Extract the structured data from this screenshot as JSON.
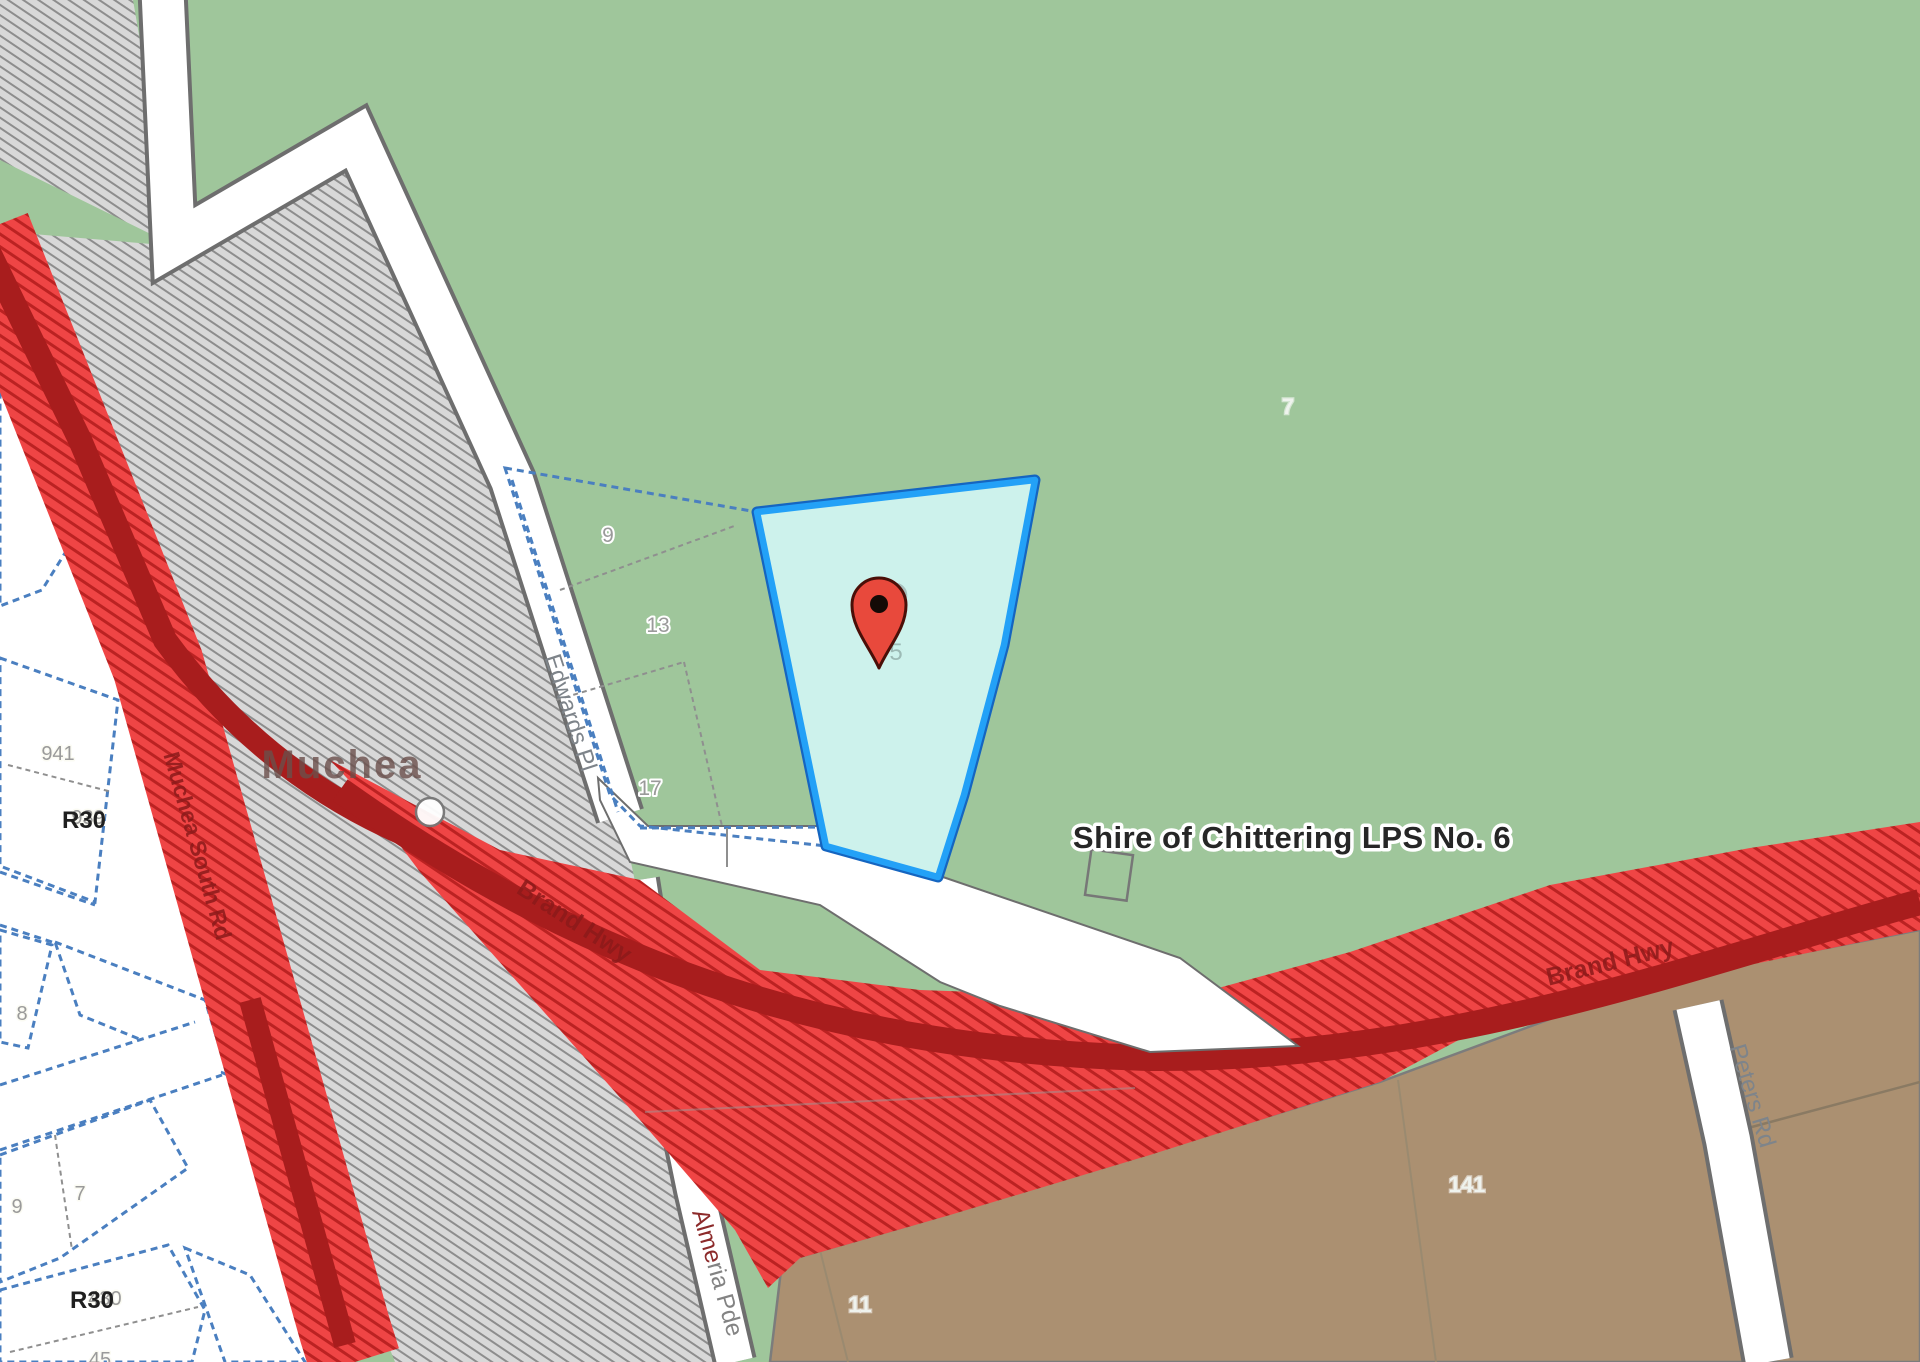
{
  "labels": {
    "plan_title": "Shire of Chittering LPS No. 6",
    "locality": "Muchea"
  },
  "roads": {
    "edwards": "Edwards Pl",
    "muchea_south": "Muchea South Rd",
    "brand_hwy_west": "Brand Hwy",
    "brand_hwy_east": "Brand Hwy",
    "almeria_prefix": "Alme",
    "almeria_suffix": "ria Pde",
    "peters": "Peters Rd"
  },
  "lots": {
    "selected": "5",
    "lot9": "9",
    "lot13": "13",
    "lot17": "17",
    "lot941": "941",
    "lot939": "939",
    "lot8": "8",
    "lot9_west": "9",
    "lot7_west": "7",
    "lot430": "430",
    "lot45": "45",
    "lot141": "141",
    "lot11": "11",
    "lot7_green": "7"
  },
  "zoning": {
    "r30_north": "R30",
    "r30_south": "R30"
  },
  "colors": {
    "base_green": "#9fc69b",
    "parcel_cream": "#f1f1e3",
    "brown_zone": "#ab9071",
    "grey_hatch_bg": "#d8d8d8",
    "grey_hatch_line": "#8d8d8d",
    "red_hatch_bg": "#ef4545",
    "red_hatch_line": "#bb2222",
    "highway_pavement": "#a81d1d",
    "green_hatch_bg": "#36ac66",
    "green_hatch_line": "#277c49",
    "selected_fill": "#cdf2ec",
    "selected_border": "#23a1f7",
    "cadastral_blue": "#4a7fc0",
    "pin_red": "#e8493c"
  }
}
